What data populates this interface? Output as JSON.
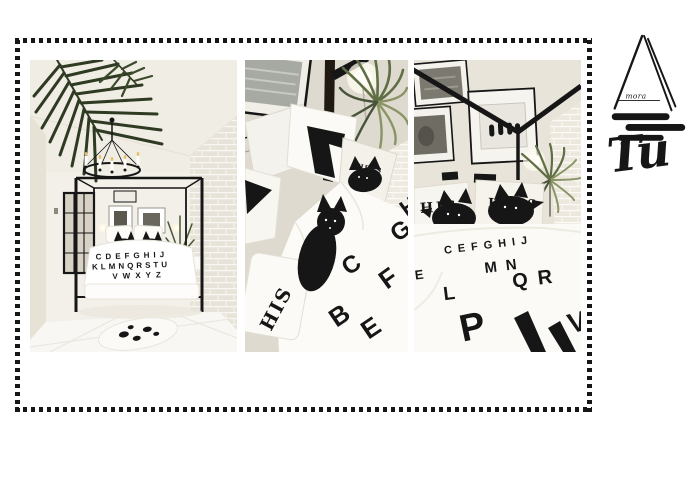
{
  "logo": {
    "monogram": "mora",
    "wordmark": "Tu"
  },
  "gallery": {
    "photos": [
      {
        "bedding_rows": [
          "CDEFGHIJ",
          "KLMNQRSTU",
          "VWXYZ"
        ]
      },
      {
        "pillow_text": "HIS",
        "pillow_tag": "HERS",
        "duvet_letters": [
          "G",
          "C",
          "F",
          "B",
          "E",
          "H"
        ]
      },
      {
        "pillow_left": "HIS",
        "pillow_right": "HERS",
        "duvet_letters": [
          "CEFGHIJ",
          "E",
          "MN",
          "L",
          "QR",
          "P",
          "V"
        ]
      }
    ]
  },
  "colors": {
    "ink": "#161616",
    "cream": "#e9e4da",
    "cream_dark": "#d9d3c7",
    "paper": "#f4f1eb",
    "leaf_dark": "#2e3a22",
    "leaf_mid": "#5f6e45",
    "leaf_light": "#8a9465"
  }
}
